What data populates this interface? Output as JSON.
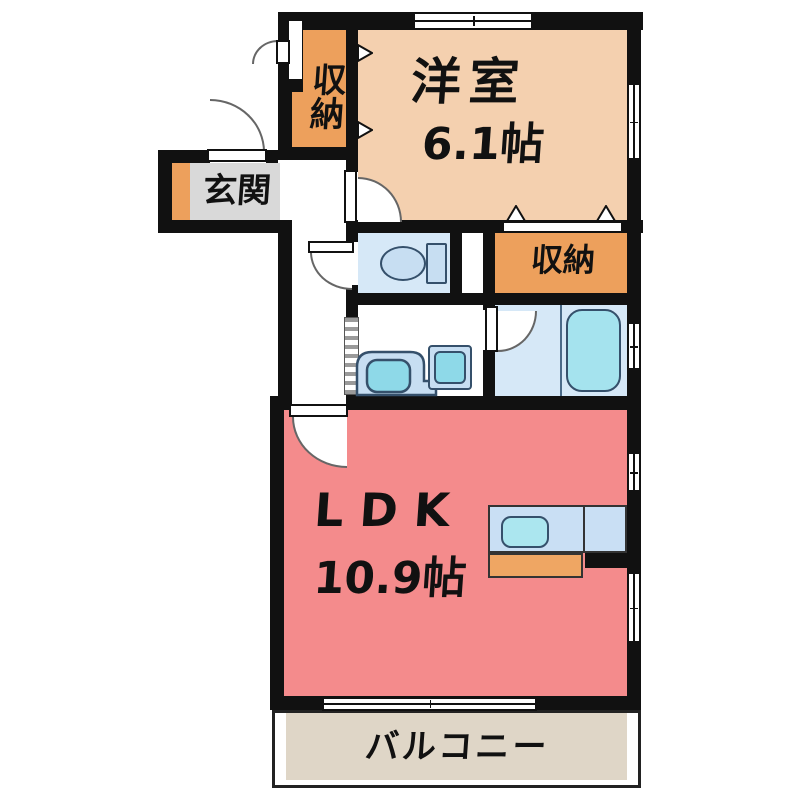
{
  "rooms": {
    "western": {
      "name": "洋室",
      "area": "6.1帖"
    },
    "closet_top": {
      "name": "収納"
    },
    "closet_right": {
      "name": "収納"
    },
    "entry": {
      "name": "玄関"
    },
    "ldk": {
      "name": "LDK",
      "area": "10.9帖"
    },
    "balcony": {
      "name": "バルコニー"
    }
  },
  "colors": {
    "wall": "#111111",
    "text": "#111111",
    "door_stroke": "#666666",
    "western": "#F4D0AF",
    "storage": "#EDA05C",
    "entry_floor": "#D9D9D9",
    "entry_step": "#EDA05C",
    "ldk": "#F48B8C",
    "balcony": "#DFD6C7",
    "water_room": "#D6E8F7",
    "tub": "#A5E3EE",
    "fixture_blue": "#C7DEF2",
    "fixture_cyan": "#8ED9E8",
    "fixture_stroke": "#35506B",
    "kitchen_counter": "#C9DFF4",
    "sink": "#ABE6EF",
    "range": "#EFA663"
  }
}
